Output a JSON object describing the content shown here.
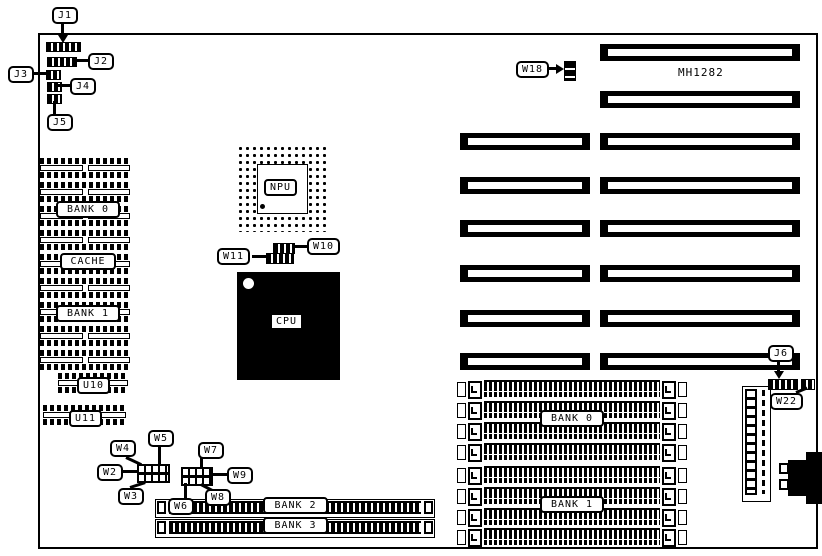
{
  "board": {
    "model_text": "MH1282"
  },
  "callouts": {
    "j1": "J1",
    "j2": "J2",
    "j3": "J3",
    "j4": "J4",
    "j5": "J5",
    "j6": "J6",
    "w2": "W2",
    "w3": "W3",
    "w4": "W4",
    "w5": "W5",
    "w6": "W6",
    "w7": "W7",
    "w8": "W8",
    "w9": "W9",
    "w10": "W10",
    "w11": "W11",
    "w18": "W18",
    "w22": "W22"
  },
  "chips": {
    "npu": "NPU",
    "cpu": "CPU",
    "u10": "U10",
    "u11": "U11"
  },
  "memory": {
    "dip_bank0": "BANK 0",
    "cache": "CACHE",
    "dip_bank1": "BANK 1",
    "simm_bank0": "BANK 0",
    "simm_bank1": "BANK 1",
    "bank2": "BANK 2",
    "bank3": "BANK 3"
  },
  "colors": {
    "ink": "#000000",
    "paper": "#ffffff"
  }
}
